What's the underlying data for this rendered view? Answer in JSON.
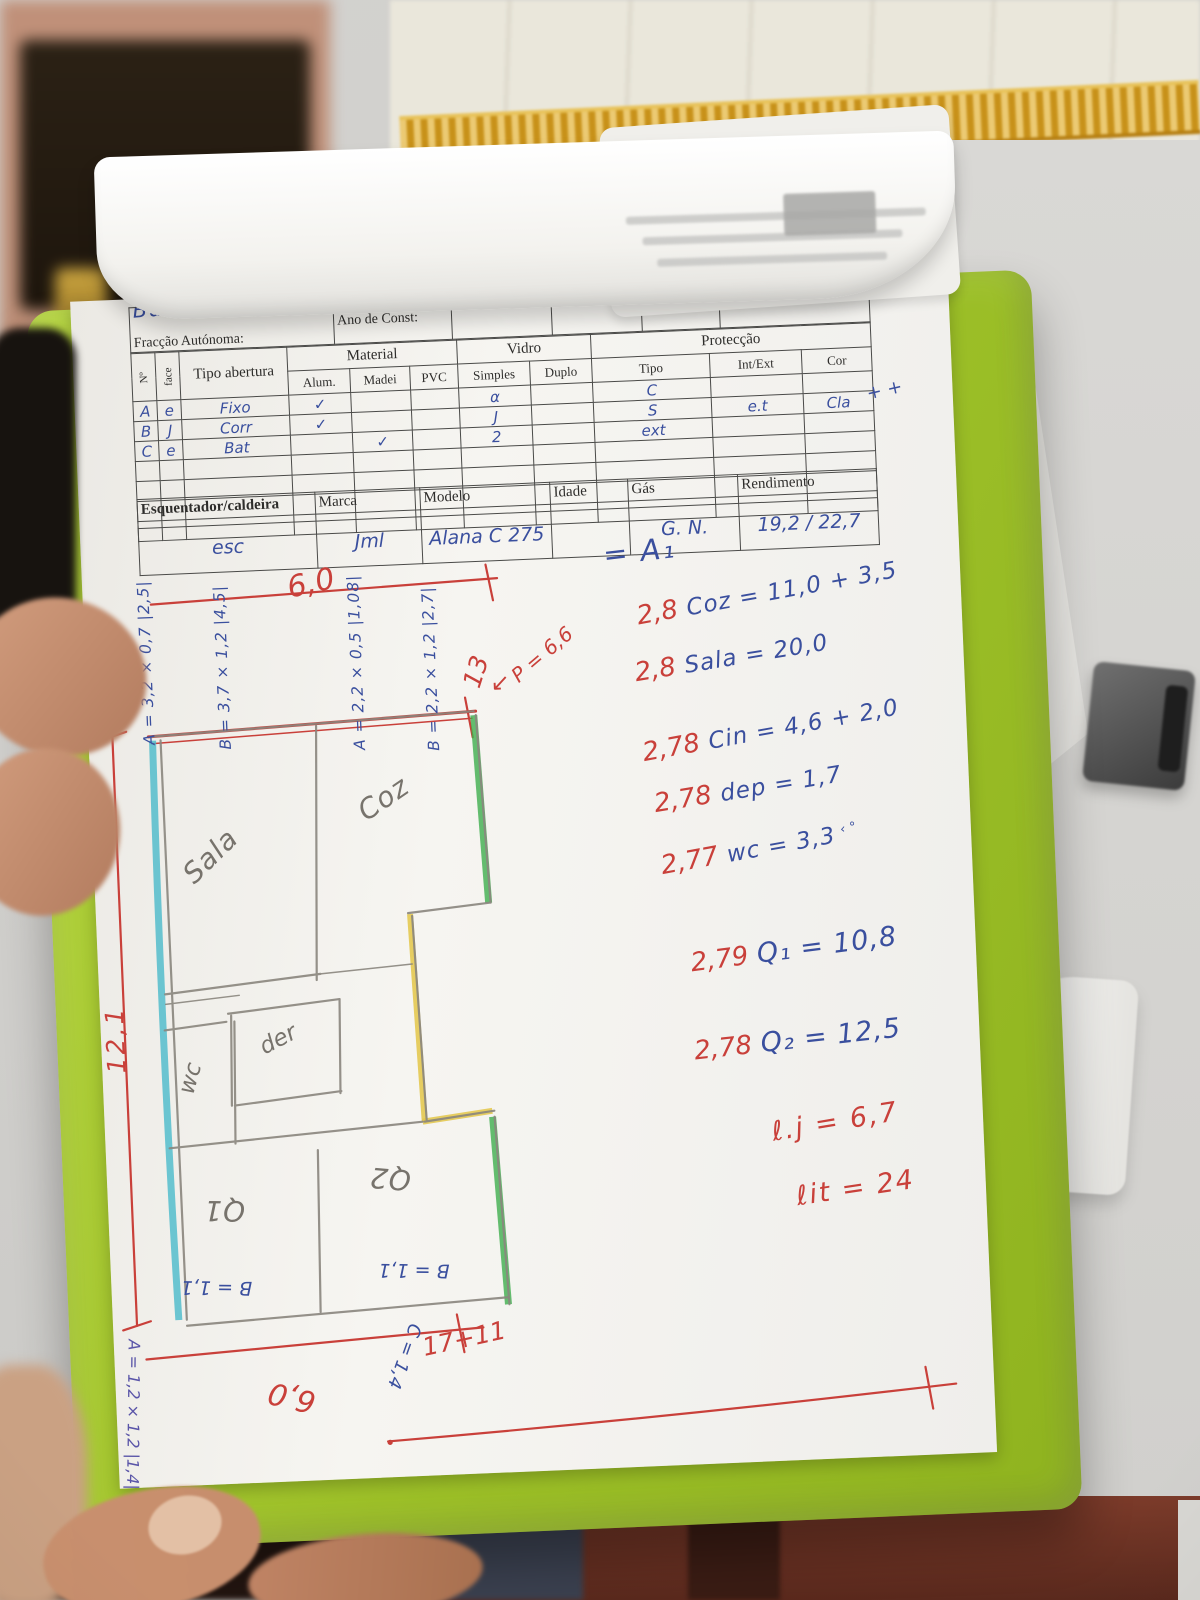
{
  "form": {
    "handwritten_name": "Bacah Olange",
    "fields": {
      "fraccao": "Fracção Autónoma:",
      "ano": "Ano de Const:",
      "altitude": "Altitude:",
      "pre_frente": "Pré.Frente?",
      "elevador": "Elevador",
      "pavimento": "Pavimento e Cobertura"
    }
  },
  "openings_table": {
    "corner_cols": {
      "num": "Nº",
      "face": "face",
      "tipo_abertura": "Tipo abertura"
    },
    "groups": {
      "material": "Material",
      "vidro": "Vidro",
      "proteccao": "Protecção"
    },
    "subheaders": [
      "Alum.",
      "Madei",
      "PVC",
      "Simples",
      "Duplo",
      "Tipo",
      "Int/Ext",
      "Cor"
    ],
    "rows": [
      [
        "A",
        "e",
        "Fixo",
        "✓",
        "",
        "",
        "α",
        "",
        "C",
        "",
        ""
      ],
      [
        "B",
        "J",
        "Corr",
        "✓",
        "",
        "",
        "J",
        "",
        "S",
        "e.t",
        "Cla"
      ],
      [
        "C",
        "e",
        "Bat",
        "",
        "✓",
        "",
        "2",
        "",
        "ext",
        "",
        ""
      ]
    ],
    "margin_note": "+ +"
  },
  "heater_table": {
    "headers": [
      "Esquentador/caldeira",
      "Marca",
      "Modelo",
      "Idade",
      "Gás",
      "Rendimento"
    ],
    "values": [
      "esc",
      "Jml",
      "Alana C\n275",
      "",
      "G. N.",
      "19,2 / 22,7"
    ]
  },
  "calc": {
    "a1": "= A₁",
    "lines": [
      {
        "coef": "2,8",
        "expr": "Coz = 11,0 + 3,5"
      },
      {
        "coef": "2,8",
        "expr": "Sala = 20,0"
      },
      {
        "coef": "2,78",
        "expr": "Cin = 4,6 + 2,0"
      },
      {
        "coef": "2,78",
        "expr": "dep = 1,7"
      },
      {
        "coef": "2,77",
        "expr": "wc = 3,3",
        "suffix": "‹ °"
      },
      {
        "coef": "2,79",
        "expr": "Q₁ = 10,8"
      },
      {
        "coef": "2,78",
        "expr": "Q₂ = 12,5"
      }
    ],
    "lj": "ℓ.j = 6,7",
    "lit": "ℓit = 24"
  },
  "plan": {
    "rooms": {
      "sala": "Sala",
      "coz": "Coz",
      "wc": "wc",
      "dep": "der",
      "q1": "Q1",
      "q2": "Q2"
    },
    "window_measures": [
      "A = 3,2 × 0,7   |2,5|",
      "B = 3,7 × 1,2   |4,5|",
      "A = 2,2 × 0,5   |1,08|",
      "B = 2,2 × 1,2   |2,7|"
    ],
    "dims": {
      "top_width": "6,0",
      "left_height": "12,1",
      "thirteen": "13",
      "perimeter": "P = 6,6",
      "arrow": "↙",
      "bottom_sum": "17+11",
      "bottom_width": "6,0",
      "q1_b": "B = 1,1",
      "q2_b": "B = 1,1",
      "c_dim": "C = 1,4",
      "a_bottom": "A = 1,2 × 1,2  |1,4|"
    }
  },
  "colors": {
    "clipboard": "#9dc028",
    "marker_cyan": "#45b9c9",
    "marker_green": "#3fae4e",
    "marker_yellow": "#e3c648",
    "pen_blue": "#3a4f9e",
    "pen_red": "#c9403a",
    "pencil": "#8a867e"
  }
}
